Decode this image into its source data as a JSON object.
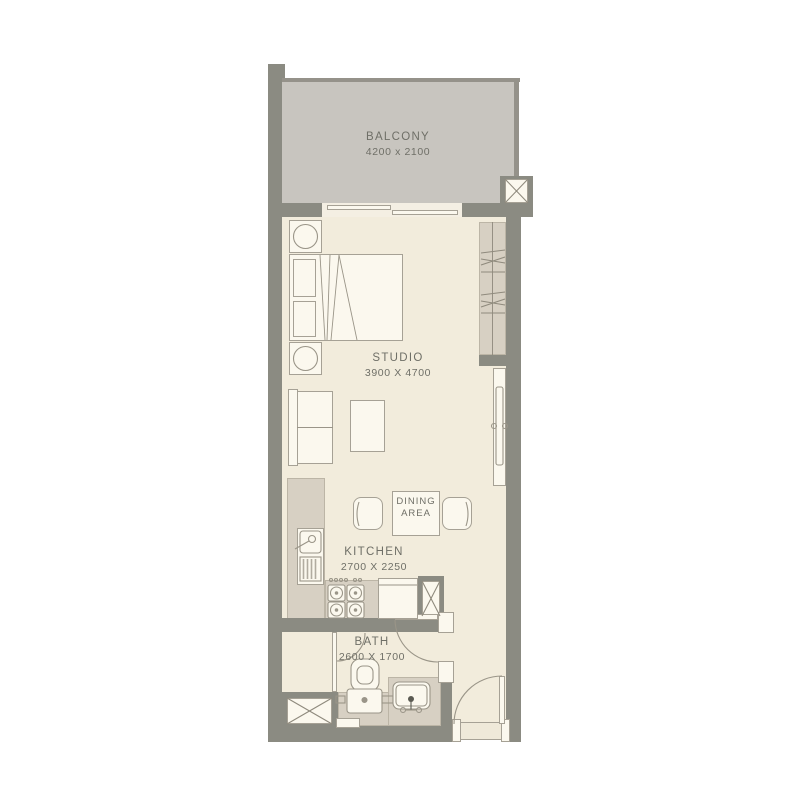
{
  "rooms": {
    "balcony": {
      "label": "BALCONY",
      "dimensions": "4200 x 2100"
    },
    "studio": {
      "label": "STUDIO",
      "dimensions": "3900 X 4700"
    },
    "dining_area": {
      "label_line1": "DINING",
      "label_line2": "AREA"
    },
    "kitchen": {
      "label": "KITCHEN",
      "dimensions": "2700 X 2250"
    },
    "bath": {
      "label": "BATH",
      "dimensions": "2600 X 1700"
    }
  },
  "colors": {
    "wall": "#8b8b82",
    "balcony_floor": "#c8c5bf",
    "interior_floor": "#f2ecdc",
    "fixture_fill": "#fbf8ee",
    "counter_tan": "#d7d0c3",
    "outline": "#9a9588",
    "label_text": "#6f6f67"
  }
}
